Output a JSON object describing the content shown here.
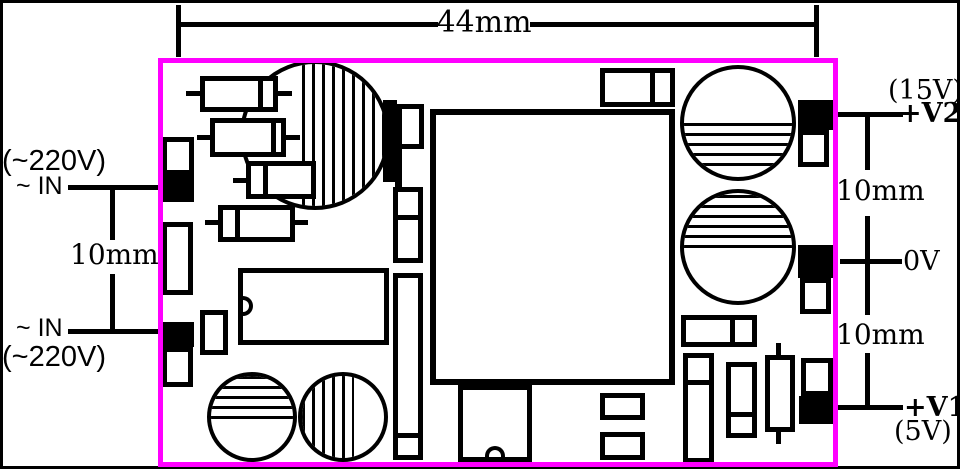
{
  "colors": {
    "board_outline": "#ff00ff",
    "ink": "#000000",
    "background": "#ffffff"
  },
  "dimensions": {
    "board_width": "44mm",
    "input_pin_pitch": "10mm",
    "output_pitch_v2_to_0v": "10mm",
    "output_pitch_0v_to_v1": "10mm"
  },
  "inputs": {
    "top": {
      "voltage": "(~220V)",
      "ac_mark": "~",
      "pin": "IN"
    },
    "bottom": {
      "ac_mark": "~",
      "pin": "IN",
      "voltage": "(~220V)"
    }
  },
  "outputs": {
    "v2": {
      "voltage": "(15V)",
      "pin": "+V2"
    },
    "zero": {
      "pin": "0V"
    },
    "v1": {
      "pin": "+V1",
      "voltage": "(5V)"
    }
  }
}
